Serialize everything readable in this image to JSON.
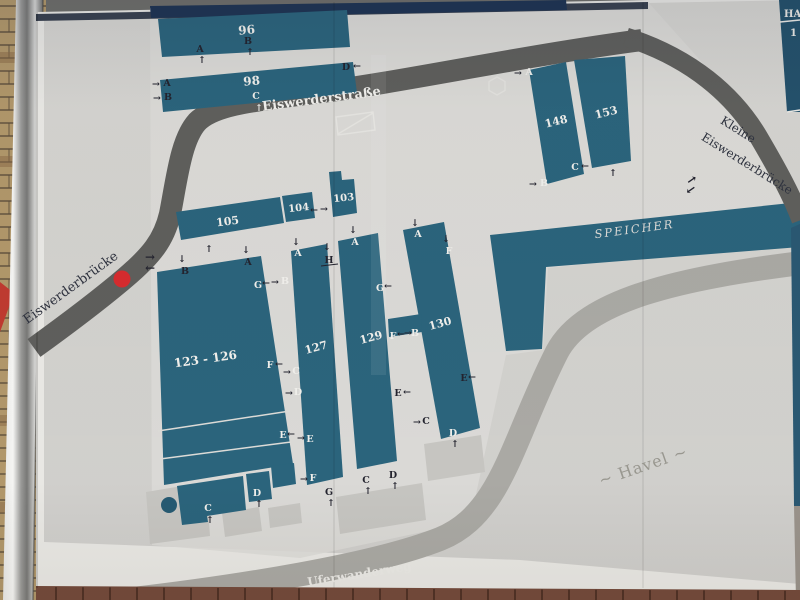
{
  "title": "Eiswerder site plan board",
  "colors": {
    "building": "#2b647c",
    "building_dark": "#265a72",
    "road": "#5f5f5c",
    "foot_path": "#aaa9a4",
    "marker_red": "#d62b2e",
    "map_base": "#d2d1cd",
    "island": "#dcdbd7",
    "board_base": "#e9e8e4",
    "board_edge": "#39414f",
    "navy_band": "#1e3452",
    "label_dark": "#23232e",
    "label_light": "#f0efeb",
    "apron": "#c6c5c1",
    "white_line": "#dcdbd7",
    "legend_panel": "#24516b",
    "sliver_teal": "#2a5872",
    "brick_wall": "#b1976a",
    "brick_mortar": "#5a4c3a",
    "brick_dark": "#8a6a46",
    "brick_bottom": "#744a3b",
    "brick_bottom_joint": "#44291f",
    "red_triangle": "#bf3a30"
  },
  "legend": {
    "line1": "HA",
    "line2": "1"
  },
  "marker": {
    "cx": 122,
    "cy": 279,
    "r": 8.5
  },
  "roads": [
    {
      "name": "eiswerderstrasse-road",
      "d": "M34,348 C70,322 105,295 125,278 C151,256 164,240 170,214 C177,178 181,140 197,122 C215,103 262,100 322,92 C402,82 522,56 642,40",
      "w": 22,
      "kind": "road"
    },
    {
      "name": "kleine-eiswerderbruecke-road",
      "d": "M626,37 C692,58 734,96 758,136 C778,170 792,196 801,220",
      "w": 19,
      "kind": "road",
      "late": true
    },
    {
      "name": "uferwanderweg-path",
      "d": "M116,601 C240,587 374,565 440,539 C502,514 512,440 557,352 C585,299 682,278 801,263",
      "w": 24,
      "kind": "path"
    }
  ],
  "buildings": [
    {
      "id": "96",
      "n": "96",
      "pts": "158,19 347,10 350,47 162,57",
      "lx": 247,
      "ly": 34,
      "r": -5,
      "fs": 12
    },
    {
      "id": "98",
      "n": "98",
      "pts": "160,80 353,62 357,93 163,112",
      "lx": 252,
      "ly": 85,
      "r": -5,
      "fs": 12
    },
    {
      "id": "148",
      "n": "148",
      "pts": "529,70 566,62 584,174 547,184",
      "lx": 557,
      "ly": 125,
      "r": -14,
      "fs": 11
    },
    {
      "id": "153",
      "n": "153",
      "pts": "574,60 625,56 631,161 592,168",
      "lx": 607,
      "ly": 116,
      "r": -14,
      "fs": 11
    },
    {
      "id": "105",
      "n": "105",
      "pts": "176,212 280,197 284,223 181,240",
      "lx": 228,
      "ly": 225,
      "r": -7,
      "fs": 11
    },
    {
      "id": "104",
      "n": "104",
      "pts": "282,196 312,192 315,218 286,222",
      "lx": 299,
      "ly": 211,
      "r": -6,
      "fs": 10
    },
    {
      "id": "103",
      "n": "103",
      "pts": "329,172 341,171 342,180 354,179 357,213 333,217",
      "lx": 344,
      "ly": 201,
      "r": -6,
      "fs": 10
    },
    {
      "id": "123-126",
      "n": "123 - 126",
      "pts": "157,272 261,256 293,464 164,485",
      "lx": 206,
      "ly": 363,
      "r": -8,
      "fs": 12
    },
    {
      "id": "123-126-annex-left",
      "n": "",
      "pts": "177,486 243,476 246,510 207,516 208,522 182,525"
    },
    {
      "id": "123-126-annex-mid",
      "n": "",
      "pts": "246,474 269,471 272,499 249,502"
    },
    {
      "id": "123-126-annex-right",
      "n": "",
      "pts": "271,466 294,463 296,484 273,488"
    },
    {
      "id": "127",
      "n": "127",
      "pts": "291,251 327,244 343,477 307,485",
      "lx": 317,
      "ly": 351,
      "r": -15,
      "fs": 11
    },
    {
      "id": "129",
      "n": "129",
      "pts": "338,241 378,233 397,461 357,469",
      "lx": 372,
      "ly": 341,
      "r": -15,
      "fs": 11
    },
    {
      "id": "130",
      "n": "130",
      "pts": "403,230 444,222 480,428 441,439",
      "lx": 441,
      "ly": 327,
      "r": -15,
      "fs": 11
    },
    {
      "id": "bridge-129-130",
      "n": "",
      "pts": "388,319 421,314 422,332 389,337"
    },
    {
      "id": "speicher",
      "n": "",
      "pts": "490,235 800,202 800,247 546,267 542,349 506,351"
    }
  ],
  "name_labels": [
    {
      "t": "Eiswerderstraße",
      "x": 322,
      "y": 103,
      "r": -7.5,
      "fs": 13,
      "c": "#f2f1ed",
      "w": "bold"
    },
    {
      "t": "Eiswerderbrücke",
      "x": 73,
      "y": 291,
      "r": -36,
      "fs": 13,
      "c": "#2e323e"
    },
    {
      "t": "Kleine",
      "x": 736,
      "y": 133,
      "r": 32,
      "fs": 12,
      "c": "#2e323e"
    },
    {
      "t": "Eiswerderbrücke",
      "x": 745,
      "y": 167,
      "r": 32,
      "fs": 12,
      "c": "#2e323e"
    },
    {
      "t": "SPEICHER",
      "x": 635,
      "y": 233,
      "r": -7.5,
      "fs": 11.5,
      "c": "#dbdad6",
      "ls": 2,
      "i": true
    },
    {
      "t": "~ Havel ~",
      "x": 645,
      "y": 471,
      "r": -19,
      "fs": 16,
      "c": "#98978f",
      "ls": 1
    },
    {
      "t": "Uferwanderweg",
      "x": 360,
      "y": 578,
      "r": -9,
      "fs": 12,
      "c": "#ebeae6",
      "w": "bold"
    }
  ],
  "entrance_labels": [
    [
      "A",
      200,
      52,
      "d"
    ],
    [
      "↑",
      202,
      63,
      "d"
    ],
    [
      "B",
      248,
      44,
      "d"
    ],
    [
      "↑",
      250,
      55,
      "d"
    ],
    [
      "→",
      156,
      87,
      "d"
    ],
    [
      "A",
      167,
      86,
      "d"
    ],
    [
      "→",
      157,
      101,
      "d"
    ],
    [
      "B",
      168,
      100,
      "d"
    ],
    [
      "C",
      256,
      99,
      "l"
    ],
    [
      "↑",
      259,
      111,
      "l"
    ],
    [
      "D",
      346,
      70,
      "d"
    ],
    [
      "←",
      357,
      69,
      "d"
    ],
    [
      "→",
      518,
      76,
      "d"
    ],
    [
      "A",
      529,
      75,
      "l"
    ],
    [
      "→",
      533,
      187,
      "d"
    ],
    [
      "B",
      544,
      186,
      "l"
    ],
    [
      "C",
      575,
      170,
      "l"
    ],
    [
      "←",
      585,
      169,
      "d"
    ],
    [
      "↑",
      613,
      176,
      "d"
    ],
    [
      "↑",
      209,
      252,
      "d"
    ],
    [
      "←",
      314,
      213,
      "d"
    ],
    [
      "→",
      324,
      212,
      "d"
    ],
    [
      "↓",
      182,
      262,
      "d"
    ],
    [
      "B",
      185,
      274,
      "d"
    ],
    [
      "↓",
      246,
      253,
      "d"
    ],
    [
      "A",
      248,
      265,
      "d"
    ],
    [
      "G",
      258,
      288,
      "l"
    ],
    [
      "←",
      266,
      286,
      "d"
    ],
    [
      "→",
      275,
      285,
      "d"
    ],
    [
      "B",
      285,
      284,
      "l"
    ],
    [
      "F",
      270,
      368,
      "l"
    ],
    [
      "←",
      279,
      367,
      "d"
    ],
    [
      "E",
      283,
      438,
      "l"
    ],
    [
      "←",
      291,
      437,
      "d"
    ],
    [
      "→",
      301,
      441,
      "d"
    ],
    [
      "E",
      310,
      442,
      "l"
    ],
    [
      "C",
      208,
      511,
      "l"
    ],
    [
      "↑",
      210,
      523,
      "d"
    ],
    [
      "D",
      257,
      496,
      "l"
    ],
    [
      "↑",
      259,
      507,
      "d"
    ],
    [
      "↓",
      296,
      245,
      "d"
    ],
    [
      "A",
      298,
      256,
      "l"
    ],
    [
      "↓",
      327,
      250,
      "d"
    ],
    [
      "H",
      329,
      263,
      "d"
    ],
    [
      "→",
      287,
      375,
      "d"
    ],
    [
      "C",
      296,
      374,
      "l"
    ],
    [
      "→",
      289,
      396,
      "d"
    ],
    [
      "D",
      298,
      395,
      "l"
    ],
    [
      "→",
      304,
      482,
      "d"
    ],
    [
      "F",
      313,
      481,
      "l"
    ],
    [
      "G",
      329,
      495,
      "d"
    ],
    [
      "↑",
      331,
      506,
      "d"
    ],
    [
      "↓",
      353,
      233,
      "d"
    ],
    [
      "A",
      355,
      245,
      "l"
    ],
    [
      "G",
      380,
      291,
      "l"
    ],
    [
      "←",
      388,
      289,
      "d"
    ],
    [
      "F",
      393,
      339,
      "l"
    ],
    [
      "←",
      401,
      337,
      "d"
    ],
    [
      "→",
      408,
      336,
      "d"
    ],
    [
      "B",
      415,
      336,
      "l"
    ],
    [
      "E",
      398,
      396,
      "d"
    ],
    [
      "←",
      407,
      395,
      "d"
    ],
    [
      "C",
      366,
      483,
      "d"
    ],
    [
      "↑",
      368,
      494,
      "d"
    ],
    [
      "D",
      393,
      478,
      "d"
    ],
    [
      "↑",
      395,
      489,
      "d"
    ],
    [
      "↓",
      415,
      226,
      "d"
    ],
    [
      "A",
      418,
      237,
      "l"
    ],
    [
      "↓",
      446,
      242,
      "d"
    ],
    [
      "F",
      449,
      254,
      "l"
    ],
    [
      "→",
      417,
      425,
      "d"
    ],
    [
      "C",
      426,
      424,
      "d"
    ],
    [
      "D",
      453,
      436,
      "l"
    ],
    [
      "↑",
      455,
      447,
      "d"
    ],
    [
      "E",
      464,
      381,
      "d"
    ],
    [
      "←",
      472,
      380,
      "d"
    ],
    [
      "→",
      150,
      261,
      "d",
      0,
      12
    ],
    [
      "←",
      150,
      272,
      "d",
      0,
      12
    ],
    [
      "→",
      694,
      183,
      "d",
      -35,
      12
    ],
    [
      "←",
      693,
      193,
      "d",
      -35,
      12
    ]
  ],
  "extras": {
    "partition_lines": [
      [
        158,
        431,
        290,
        411
      ],
      [
        160,
        459,
        291,
        442
      ]
    ],
    "h_underline": [
      321,
      266,
      338,
      264
    ],
    "seams": [
      334,
      643
    ],
    "hexagon": {
      "cx": 497,
      "cy": 86,
      "r": 9
    },
    "crossed_rect": {
      "pts": "336,117 373,112 375,130 338,135",
      "diag": [
        338,
        134,
        373,
        113
      ]
    },
    "aprons": [
      "146,492 206,482 210,536 150,544",
      "222,513 259,507 262,531 225,537",
      "268,508 300,503 302,523 270,528",
      "336,497 422,483 426,520 340,534",
      "424,444 481,435 485,472 428,481"
    ],
    "teal_circle": {
      "cx": 169,
      "cy": 505,
      "r": 8
    },
    "island_pts": "150,8 648,2 700,60 782,162 795,215 700,252 548,268 543,350 506,355 470,522 300,558 152,545",
    "map_pts": "44,16 645,3 800,0 800,584 520,560 44,542",
    "board_pts": "36,12 648,0 800,0 800,592 36,588",
    "top_edge_pts": "36,14 648,2 648,9 36,21",
    "navy_band_pts": "150,6 566,0 567,10 151,18",
    "bottom_brick_pts": "36,586 800,590 800,600 36,600",
    "post_pts": "16,0 43,0 33,600 3,600",
    "red_triangle_pts": "0,282 14,293 0,332",
    "sliver_pts": "791,228 800,224 800,506 794,506",
    "sliver_lower_pts": "794,506 800,506 800,600 796,600"
  }
}
